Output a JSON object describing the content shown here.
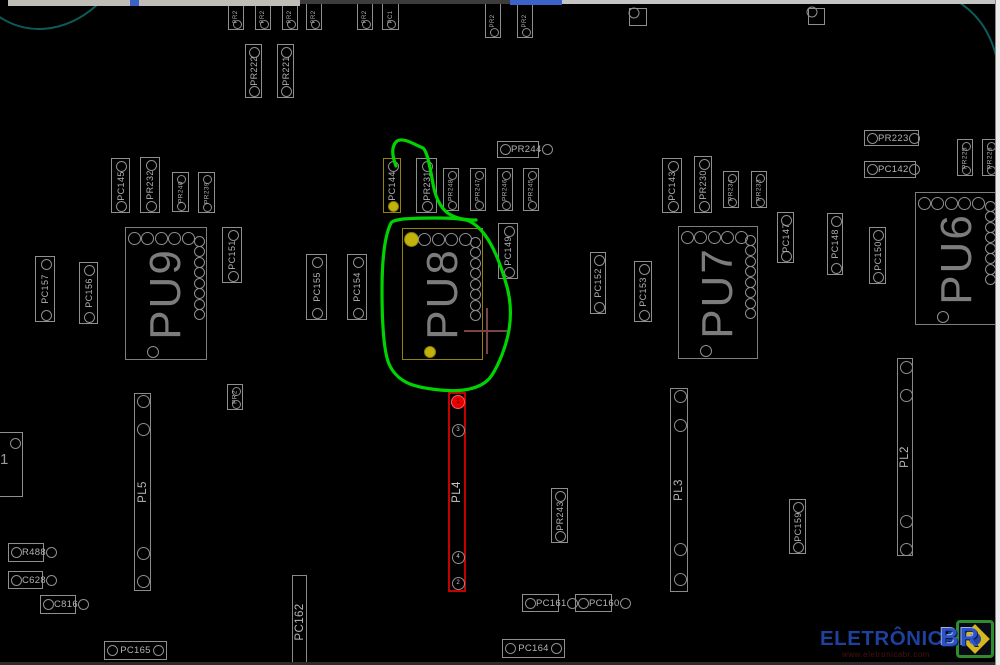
{
  "watermark": {
    "brand": "ELETRÔNICA",
    "suffix": "BR",
    "url": "www.eletronicabr.com"
  },
  "colors": {
    "background": "#000000",
    "component_outline": "#8f8f8f",
    "component_text": "#b2b2b2",
    "chip_text": "#7c7c7c",
    "highlight_yellow": "#c2b20c",
    "highlight_yellow_outline": "#94820a",
    "highlight_red": "#c40000",
    "pin1_red": "#e60000",
    "annotation_green": "#00d400",
    "crosshair": "#7a4444",
    "board_arc": "#0e5a5a",
    "watermark_blue": "#1e419e",
    "watermark_url_red": "#4a1212"
  },
  "board": {
    "chips": [
      {
        "label": "PU9",
        "x": 125,
        "y": 227,
        "w": 82,
        "h": 133,
        "highlight": false
      },
      {
        "label": "PU8",
        "x": 402,
        "y": 228,
        "w": 81,
        "h": 132,
        "highlight": true
      },
      {
        "label": "PU7",
        "x": 678,
        "y": 226,
        "w": 80,
        "h": 133,
        "highlight": false
      },
      {
        "label": "PU6",
        "x": 915,
        "y": 192,
        "w": 83,
        "h": 133,
        "highlight": false
      }
    ],
    "connectors": [
      {
        "label": "PL5",
        "x": 134,
        "y": 393,
        "w": 17,
        "h": 198,
        "red": false,
        "pins": [
          {
            "dy": 7
          },
          {
            "dy": 35
          },
          {
            "dy": 159
          },
          {
            "dy": 187
          }
        ]
      },
      {
        "label": "PL4",
        "x": 448,
        "y": 392,
        "w": 18,
        "h": 200,
        "red": true,
        "pins": [
          {
            "dy": 8,
            "n": "1",
            "first": true
          },
          {
            "dy": 36,
            "n": "3"
          },
          {
            "dy": 163,
            "n": "4"
          },
          {
            "dy": 189,
            "n": "2"
          }
        ]
      },
      {
        "label": "PL3",
        "x": 670,
        "y": 388,
        "w": 18,
        "h": 204,
        "red": false,
        "pins": [
          {
            "dy": 7
          },
          {
            "dy": 36
          },
          {
            "dy": 160
          },
          {
            "dy": 190
          }
        ]
      },
      {
        "label": "PL2",
        "x": 897,
        "y": 358,
        "w": 16,
        "h": 198,
        "red": false,
        "pins": [
          {
            "dy": 8
          },
          {
            "dy": 36
          },
          {
            "dy": 162
          },
          {
            "dy": 190
          }
        ]
      },
      {
        "label": "PC162",
        "x": 292,
        "y": 575,
        "w": 15,
        "h": 93,
        "red": false,
        "pins": []
      }
    ],
    "vsmall": [
      {
        "label": "PR2",
        "x": 228,
        "y": 3,
        "w": 16,
        "h": 27,
        "edge": true
      },
      {
        "label": "PR2",
        "x": 255,
        "y": 3,
        "w": 16,
        "h": 27,
        "edge": true
      },
      {
        "label": "PR2",
        "x": 282,
        "y": 3,
        "w": 16,
        "h": 27,
        "edge": true
      },
      {
        "label": "PR2",
        "x": 306,
        "y": 3,
        "w": 16,
        "h": 27,
        "edge": true
      },
      {
        "label": "PR2",
        "x": 357,
        "y": 3,
        "w": 16,
        "h": 27,
        "edge": true
      },
      {
        "label": "PC1",
        "x": 382,
        "y": 3,
        "w": 17,
        "h": 27,
        "edge": true
      },
      {
        "label": "PR2",
        "x": 485,
        "y": 3,
        "w": 16,
        "h": 35,
        "edge": true
      },
      {
        "label": "PR2",
        "x": 517,
        "y": 3,
        "w": 16,
        "h": 35,
        "edge": true
      },
      {
        "label": "PR222",
        "x": 245,
        "y": 44,
        "w": 17,
        "h": 54
      },
      {
        "label": "PR221",
        "x": 277,
        "y": 44,
        "w": 17,
        "h": 54
      },
      {
        "label": "PC145",
        "x": 111,
        "y": 158,
        "w": 19,
        "h": 55
      },
      {
        "label": "PR232",
        "x": 140,
        "y": 157,
        "w": 20,
        "h": 56
      },
      {
        "label": "PR240",
        "x": 172,
        "y": 172,
        "w": 17,
        "h": 40,
        "tiny": true
      },
      {
        "label": "PR239",
        "x": 198,
        "y": 172,
        "w": 17,
        "h": 41,
        "tiny": true
      },
      {
        "label": "PC144",
        "x": 383,
        "y": 158,
        "w": 18,
        "h": 55,
        "hl": true
      },
      {
        "label": "PR231",
        "x": 416,
        "y": 158,
        "w": 21,
        "h": 55
      },
      {
        "label": "PR248",
        "x": 443,
        "y": 168,
        "w": 16,
        "h": 43,
        "tiny": true
      },
      {
        "label": "PR247",
        "x": 470,
        "y": 168,
        "w": 16,
        "h": 43,
        "tiny": true
      },
      {
        "label": "PR246",
        "x": 497,
        "y": 168,
        "w": 16,
        "h": 43,
        "tiny": true
      },
      {
        "label": "PR245",
        "x": 523,
        "y": 168,
        "w": 16,
        "h": 43,
        "tiny": true
      },
      {
        "label": "PC149",
        "x": 498,
        "y": 223,
        "w": 20,
        "h": 56
      },
      {
        "label": "PC151",
        "x": 222,
        "y": 227,
        "w": 20,
        "h": 56
      },
      {
        "label": "PC157",
        "x": 35,
        "y": 256,
        "w": 20,
        "h": 66
      },
      {
        "label": "PC156",
        "x": 79,
        "y": 262,
        "w": 19,
        "h": 62
      },
      {
        "label": "PC155",
        "x": 306,
        "y": 254,
        "w": 21,
        "h": 66
      },
      {
        "label": "PC154",
        "x": 347,
        "y": 254,
        "w": 20,
        "h": 66
      },
      {
        "label": "PC143",
        "x": 662,
        "y": 158,
        "w": 20,
        "h": 55
      },
      {
        "label": "PR230",
        "x": 694,
        "y": 156,
        "w": 18,
        "h": 57
      },
      {
        "label": "PR234",
        "x": 723,
        "y": 171,
        "w": 16,
        "h": 37,
        "tiny": true
      },
      {
        "label": "PR233",
        "x": 751,
        "y": 171,
        "w": 16,
        "h": 37,
        "tiny": true
      },
      {
        "label": "PC152",
        "x": 590,
        "y": 252,
        "w": 16,
        "h": 62
      },
      {
        "label": "PC153",
        "x": 634,
        "y": 261,
        "w": 18,
        "h": 61
      },
      {
        "label": "PC147",
        "x": 777,
        "y": 212,
        "w": 17,
        "h": 51
      },
      {
        "label": "PC148",
        "x": 827,
        "y": 213,
        "w": 16,
        "h": 62
      },
      {
        "label": "PC150",
        "x": 869,
        "y": 227,
        "w": 17,
        "h": 57
      },
      {
        "label": "PR225",
        "x": 957,
        "y": 139,
        "w": 16,
        "h": 37,
        "tiny": true
      },
      {
        "label": "PR226",
        "x": 982,
        "y": 139,
        "w": 16,
        "h": 37,
        "tiny": true
      },
      {
        "label": "PR2",
        "x": 227,
        "y": 384,
        "w": 16,
        "h": 26,
        "tiny": true
      },
      {
        "label": "PR243",
        "x": 551,
        "y": 488,
        "w": 17,
        "h": 55
      },
      {
        "label": "PC159",
        "x": 789,
        "y": 499,
        "w": 17,
        "h": 55
      }
    ],
    "hsmall": [
      {
        "label": "PR244",
        "x": 497,
        "y": 141,
        "w": 42,
        "h": 17
      },
      {
        "label": "PR223",
        "x": 864,
        "y": 130,
        "w": 55,
        "h": 16
      },
      {
        "label": "PC142",
        "x": 864,
        "y": 161,
        "w": 52,
        "h": 17
      },
      {
        "label": "R488",
        "x": 8,
        "y": 543,
        "w": 36,
        "h": 19
      },
      {
        "label": "C628",
        "x": 8,
        "y": 571,
        "w": 35,
        "h": 18
      },
      {
        "label": "C816",
        "x": 40,
        "y": 595,
        "w": 36,
        "h": 19
      },
      {
        "label": "PC165",
        "x": 104,
        "y": 641,
        "w": 63,
        "h": 19
      },
      {
        "label": "PC164",
        "x": 502,
        "y": 639,
        "w": 63,
        "h": 19
      },
      {
        "label": "PC161",
        "x": 522,
        "y": 594,
        "w": 37,
        "h": 18
      },
      {
        "label": "PC160",
        "x": 575,
        "y": 594,
        "w": 37,
        "h": 18
      }
    ],
    "squares": [
      {
        "x": 629,
        "y": 8,
        "s": 18
      },
      {
        "x": 808,
        "y": 8,
        "s": 17
      }
    ],
    "partial_left": {
      "label": "1",
      "x": -32,
      "y": 432,
      "w": 55,
      "h": 65
    }
  },
  "annotations": {
    "green_path": "M396,166 C392,156 391,146 397,141 C404,137 415,145 423,148 C427,151 430,166 433,184 C436,201 443,211 451,215 C458,219 468,220 476,220 M391,223 C385,235 382,258 382,290 C382,322 384,352 389,364 C393,373 400,380 410,384 C423,389 450,392 464,390 C478,388 487,383 492,375 C499,364 506,347 509,330 C512,312 510,295 505,280 C500,263 493,246 485,235 C479,227 473,222 466,220 C452,217 417,218 403,219 C396,220 392,221 391,223",
    "crosshair": {
      "x": 487,
      "y": 331,
      "arm": 23
    },
    "arcs": [
      "M-2,16 C30,38 72,32 104,-2",
      "M952,-2 C974,10 989,28 996,56"
    ]
  }
}
